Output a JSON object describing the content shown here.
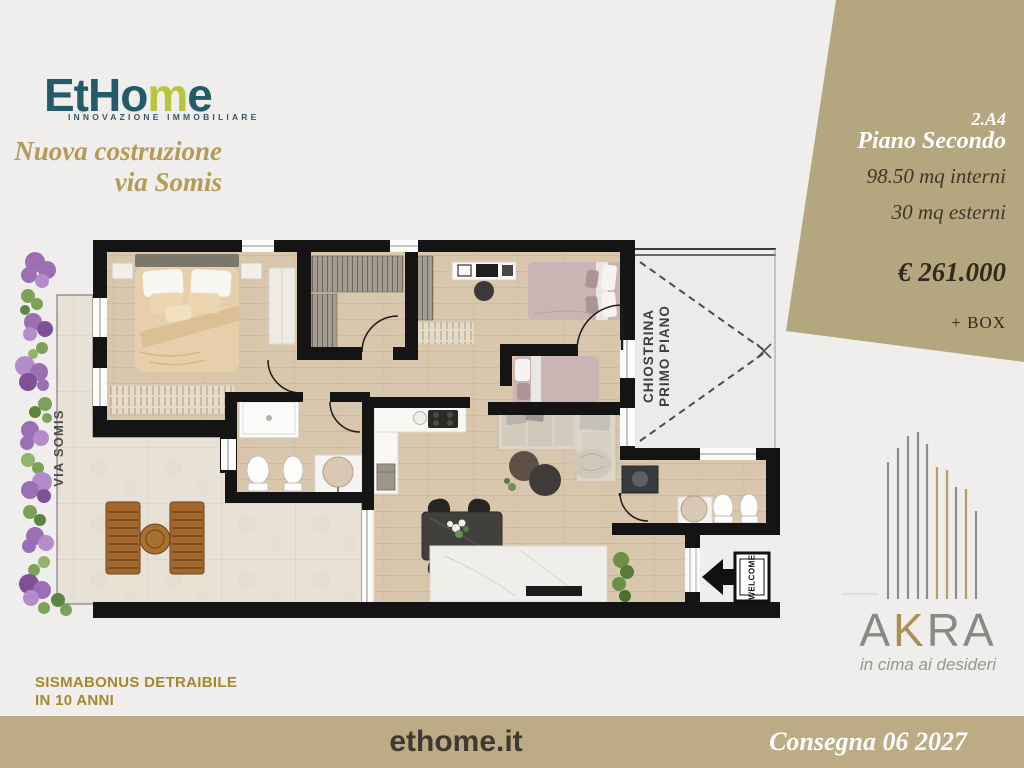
{
  "page": {
    "background": "#efeeec"
  },
  "brand": {
    "logo_teal_1": "EtHo",
    "logo_lime": "m",
    "logo_teal_2": "e",
    "tagline": "INNOVAZIONE IMMOBILIARE",
    "teal": "#235c66",
    "lime": "#b9c53b"
  },
  "headline": {
    "line1": "Nuova costruzione",
    "line2": "via Somis",
    "color": "#b59a55"
  },
  "info_panel": {
    "bg": "#b4a77f",
    "unit": "2.A4",
    "floor": "Piano Secondo",
    "interior_area": "98.50 mq interni",
    "exterior_area": "30 mq esterni",
    "price": "€ 261.000",
    "extra": "+ BOX"
  },
  "plan": {
    "street_label": "VIA SOMIS",
    "courtyard_label_1": "CHIOSTRINA",
    "courtyard_label_2": "PRIMO PIANO",
    "doormat_label": "WELCOME"
  },
  "akra": {
    "a": "A",
    "k": "K",
    "ra": "RA",
    "slogan": "in cima ai desideri",
    "gray": "#8b8986",
    "gold": "#ab9055"
  },
  "footer": {
    "bonus_line1": "SISMABONUS DETRAIBILE",
    "bonus_line2": "IN 10 ANNI",
    "website": "ethome.it",
    "delivery": "Consegna 06 2027",
    "bar_bg": "#bcab85"
  }
}
